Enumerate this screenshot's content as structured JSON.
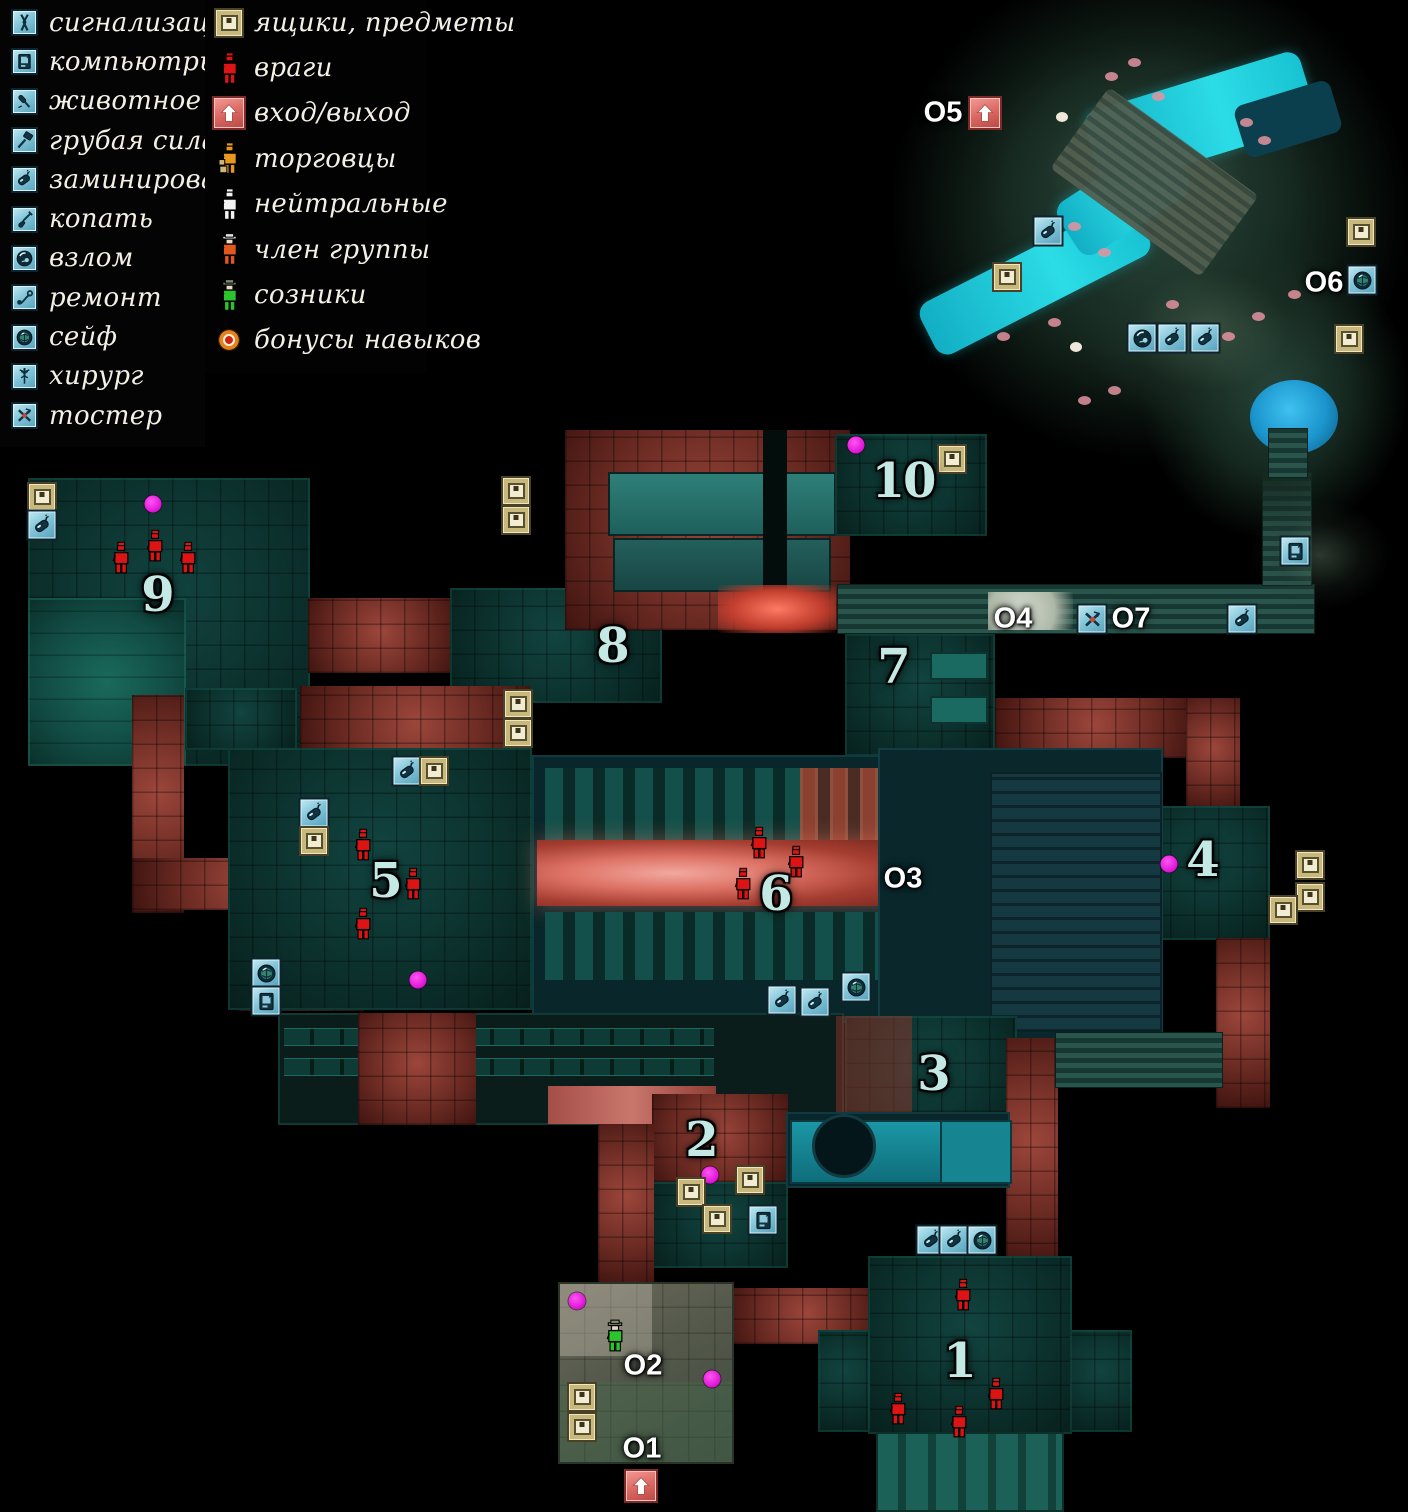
{
  "legend": {
    "column1": [
      {
        "id": "alarm",
        "label": "сигнализация"
      },
      {
        "id": "computers",
        "label": "компьютры"
      },
      {
        "id": "animal",
        "label": "животное"
      },
      {
        "id": "brute-force",
        "label": "грубая сила"
      },
      {
        "id": "mined",
        "label": "заминировано"
      },
      {
        "id": "dig",
        "label": "копать"
      },
      {
        "id": "lockpick",
        "label": "взлом"
      },
      {
        "id": "repair",
        "label": "ремонт"
      },
      {
        "id": "safe",
        "label": "сейф"
      },
      {
        "id": "surgeon",
        "label": "хирург"
      },
      {
        "id": "toaster",
        "label": "тостер"
      }
    ],
    "column2": [
      {
        "id": "box",
        "label": "ящики, предметы"
      },
      {
        "id": "enemy",
        "label": "враги"
      },
      {
        "id": "entrance",
        "label": "вход/выход"
      },
      {
        "id": "merchant",
        "label": "торговцы"
      },
      {
        "id": "neutral",
        "label": "нейтральные"
      },
      {
        "id": "group-member",
        "label": "член группы"
      },
      {
        "id": "ally",
        "label": "созники"
      },
      {
        "id": "skill-bonus",
        "label": "бонусы навыков"
      }
    ]
  },
  "map": {
    "area_labels": [
      {
        "text": "1",
        "x": 959,
        "y": 1361
      },
      {
        "text": "2",
        "x": 701,
        "y": 1140
      },
      {
        "text": "3",
        "x": 933,
        "y": 1074
      },
      {
        "text": "4",
        "x": 1202,
        "y": 860
      },
      {
        "text": "5",
        "x": 385,
        "y": 881
      },
      {
        "text": "6",
        "x": 775,
        "y": 894
      },
      {
        "text": "7",
        "x": 893,
        "y": 667
      },
      {
        "text": "8",
        "x": 612,
        "y": 646
      },
      {
        "text": "9",
        "x": 157,
        "y": 595
      },
      {
        "text": "10",
        "x": 903,
        "y": 481
      }
    ],
    "location_labels": [
      {
        "text": "O1",
        "x": 642,
        "y": 1449
      },
      {
        "text": "O2",
        "x": 643,
        "y": 1366
      },
      {
        "text": "O3",
        "x": 903,
        "y": 879
      },
      {
        "text": "O4",
        "x": 1013,
        "y": 619
      },
      {
        "text": "O5",
        "x": 943,
        "y": 113
      },
      {
        "text": "O6",
        "x": 1324,
        "y": 283
      },
      {
        "text": "O7",
        "x": 1131,
        "y": 619
      }
    ],
    "markers": [
      {
        "type": "entrance",
        "x": 985,
        "y": 113
      },
      {
        "type": "mined",
        "x": 1048,
        "y": 231
      },
      {
        "type": "box",
        "x": 1007,
        "y": 277
      },
      {
        "type": "box",
        "x": 1361,
        "y": 232
      },
      {
        "type": "safe",
        "x": 1362,
        "y": 280
      },
      {
        "type": "box",
        "x": 1349,
        "y": 339
      },
      {
        "type": "lockpick",
        "x": 1142,
        "y": 338
      },
      {
        "type": "mined",
        "x": 1172,
        "y": 338
      },
      {
        "type": "mined",
        "x": 1205,
        "y": 338
      },
      {
        "type": "computers",
        "x": 1295,
        "y": 551
      },
      {
        "type": "toaster",
        "x": 1092,
        "y": 619
      },
      {
        "type": "mined",
        "x": 1242,
        "y": 619
      },
      {
        "type": "bonus",
        "x": 856,
        "y": 445
      },
      {
        "type": "box",
        "x": 952,
        "y": 459
      },
      {
        "type": "box",
        "x": 516,
        "y": 491
      },
      {
        "type": "box",
        "x": 516,
        "y": 520
      },
      {
        "type": "box",
        "x": 518,
        "y": 704
      },
      {
        "type": "box",
        "x": 518,
        "y": 733
      },
      {
        "type": "box",
        "x": 42,
        "y": 497
      },
      {
        "type": "mined",
        "x": 42,
        "y": 525
      },
      {
        "type": "bonus",
        "x": 153,
        "y": 504
      },
      {
        "type": "enemy",
        "x": 121,
        "y": 558
      },
      {
        "type": "enemy",
        "x": 155,
        "y": 546
      },
      {
        "type": "enemy",
        "x": 188,
        "y": 558
      },
      {
        "type": "mined",
        "x": 407,
        "y": 771
      },
      {
        "type": "box",
        "x": 434,
        "y": 771
      },
      {
        "type": "mined",
        "x": 314,
        "y": 813
      },
      {
        "type": "box",
        "x": 314,
        "y": 841
      },
      {
        "type": "enemy",
        "x": 363,
        "y": 845
      },
      {
        "type": "enemy",
        "x": 413,
        "y": 884
      },
      {
        "type": "enemy",
        "x": 363,
        "y": 924
      },
      {
        "type": "bonus",
        "x": 418,
        "y": 980
      },
      {
        "type": "safe",
        "x": 266,
        "y": 973
      },
      {
        "type": "computers",
        "x": 266,
        "y": 1001
      },
      {
        "type": "enemy",
        "x": 759,
        "y": 843
      },
      {
        "type": "enemy",
        "x": 796,
        "y": 862
      },
      {
        "type": "enemy",
        "x": 743,
        "y": 884
      },
      {
        "type": "mined",
        "x": 782,
        "y": 1000
      },
      {
        "type": "mined",
        "x": 815,
        "y": 1002
      },
      {
        "type": "safe",
        "x": 856,
        "y": 987
      },
      {
        "type": "bonus",
        "x": 1169,
        "y": 864
      },
      {
        "type": "box",
        "x": 1310,
        "y": 865
      },
      {
        "type": "box",
        "x": 1310,
        "y": 897
      },
      {
        "type": "box",
        "x": 1283,
        "y": 910
      },
      {
        "type": "bonus",
        "x": 710,
        "y": 1175
      },
      {
        "type": "box",
        "x": 750,
        "y": 1180
      },
      {
        "type": "box",
        "x": 691,
        "y": 1192
      },
      {
        "type": "box",
        "x": 717,
        "y": 1219
      },
      {
        "type": "computers",
        "x": 763,
        "y": 1220
      },
      {
        "type": "mined",
        "x": 931,
        "y": 1240
      },
      {
        "type": "mined",
        "x": 954,
        "y": 1240
      },
      {
        "type": "safe",
        "x": 982,
        "y": 1240
      },
      {
        "type": "enemy",
        "x": 963,
        "y": 1295
      },
      {
        "type": "enemy",
        "x": 898,
        "y": 1409
      },
      {
        "type": "enemy",
        "x": 996,
        "y": 1394
      },
      {
        "type": "enemy",
        "x": 959,
        "y": 1422
      },
      {
        "type": "bonus",
        "x": 577,
        "y": 1301
      },
      {
        "type": "ally",
        "x": 615,
        "y": 1336
      },
      {
        "type": "bonus",
        "x": 712,
        "y": 1379
      },
      {
        "type": "box",
        "x": 582,
        "y": 1397
      },
      {
        "type": "box",
        "x": 582,
        "y": 1427
      },
      {
        "type": "entrance",
        "x": 641,
        "y": 1486
      }
    ]
  },
  "colors": {
    "enemy": "#dd1414",
    "ally": "#2cc42c",
    "neutral": "#f2f2f2",
    "merchant": "#e8981c",
    "group_member": "#e2571b",
    "bonus": "#e016d8",
    "water": "#2bdce6",
    "entrance_bg": "#d96560",
    "icon_tile_bg": "#8fcfe2",
    "box_bg": "#c9b87c"
  }
}
